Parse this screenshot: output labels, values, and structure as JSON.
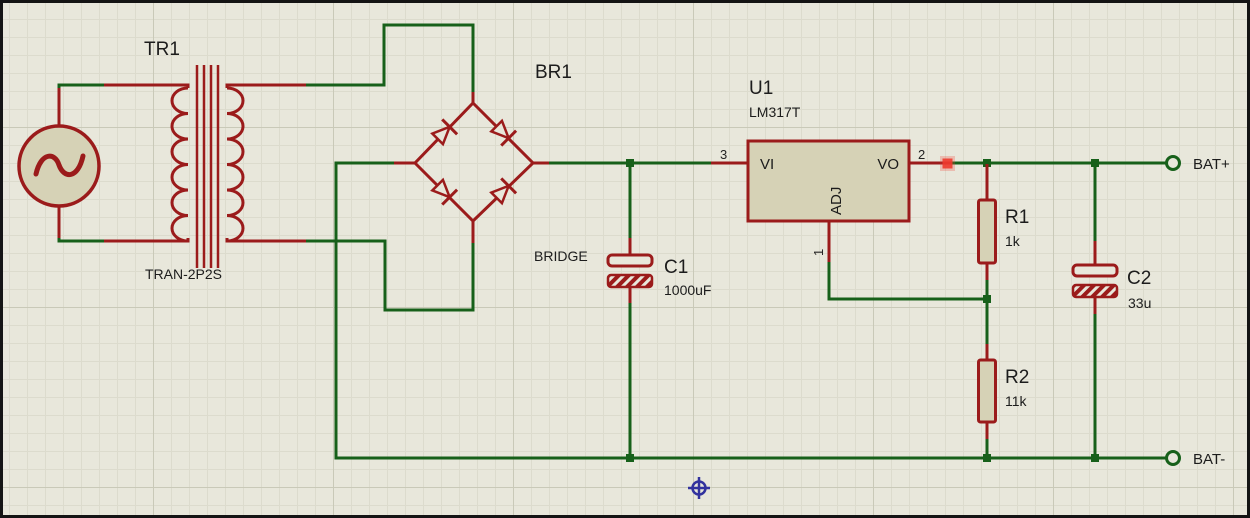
{
  "canvas": {
    "background": "#e8e7db",
    "grid_minor_color": "#dcdbcd",
    "grid_major_color": "#c9c9b8",
    "border_color": "#141414"
  },
  "colors": {
    "wire_green": "#17601a",
    "component_red": "#9b1b1b",
    "component_fill": "#d6d2b6",
    "label_text": "#1c1c1c",
    "probe_dot_red": "#ee3a2e",
    "origin_marker_blue": "#32329e"
  },
  "components": {
    "transformer": {
      "ref": "TR1",
      "value": "TRAN-2P2S"
    },
    "bridge_rectifier": {
      "ref": "BR1",
      "value": "BRIDGE"
    },
    "smoothing_capacitor": {
      "ref": "C1",
      "value": "1000uF"
    },
    "regulator": {
      "ref": "U1",
      "value": "LM317T",
      "pins": {
        "input": {
          "label": "VI",
          "number": "3"
        },
        "output": {
          "label": "VO",
          "number": "2"
        },
        "adjust": {
          "label": "ADJ",
          "number": "1"
        }
      }
    },
    "resistor_r1": {
      "ref": "R1",
      "value": "1k"
    },
    "resistor_r2": {
      "ref": "R2",
      "value": "11k"
    },
    "output_capacitor": {
      "ref": "C2",
      "value": "33u"
    }
  },
  "terminals": {
    "positive": {
      "label": "BAT+"
    },
    "negative": {
      "label": "BAT-"
    }
  }
}
